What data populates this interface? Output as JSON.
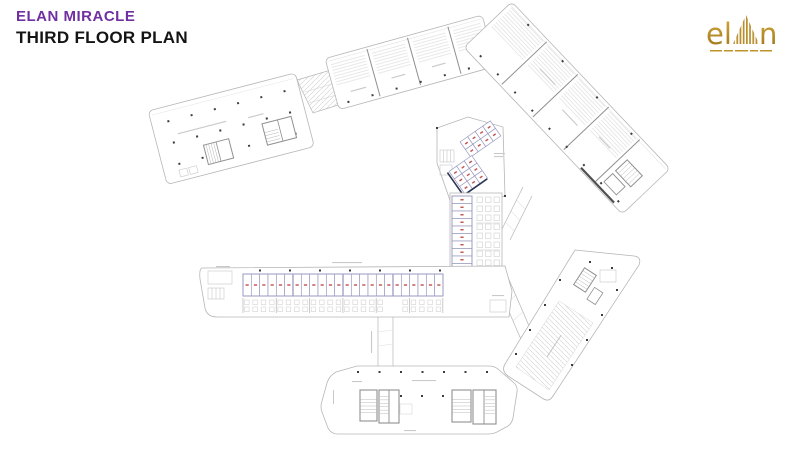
{
  "slide": {
    "brand": "ELAN MIRACLE",
    "title": "THIRD FLOOR PLAN",
    "colors": {
      "brand": "#7030A0",
      "title": "#141414",
      "background": "#FFFFFF"
    }
  },
  "logo": {
    "prefix": "el",
    "suffix": "n",
    "color": "#BF9126",
    "color_dark": "#9C7218"
  },
  "plan": {
    "colors": {
      "outline": "#b6b6b6",
      "wall": "#8f8f8f",
      "light": "#d9d9d9",
      "hatch": "#d0d0d0",
      "column": "#3d3d3d",
      "kiosk_border": "#9a9ac1",
      "kiosk_label": "#c0504d",
      "navy": "#2f3757",
      "mark": "#c9c9c9",
      "dark_wall": "#4f4f4f"
    },
    "counts": {
      "strip_kiosks": 24,
      "stack_kiosks": 10,
      "cluster_a_rows": 2,
      "cluster_a_cols": 4,
      "cluster_b_rows": 3,
      "cluster_b_cols": 3,
      "seating_rows": 8,
      "seating_cols": 3,
      "strip_seat_pairs": 24
    }
  }
}
